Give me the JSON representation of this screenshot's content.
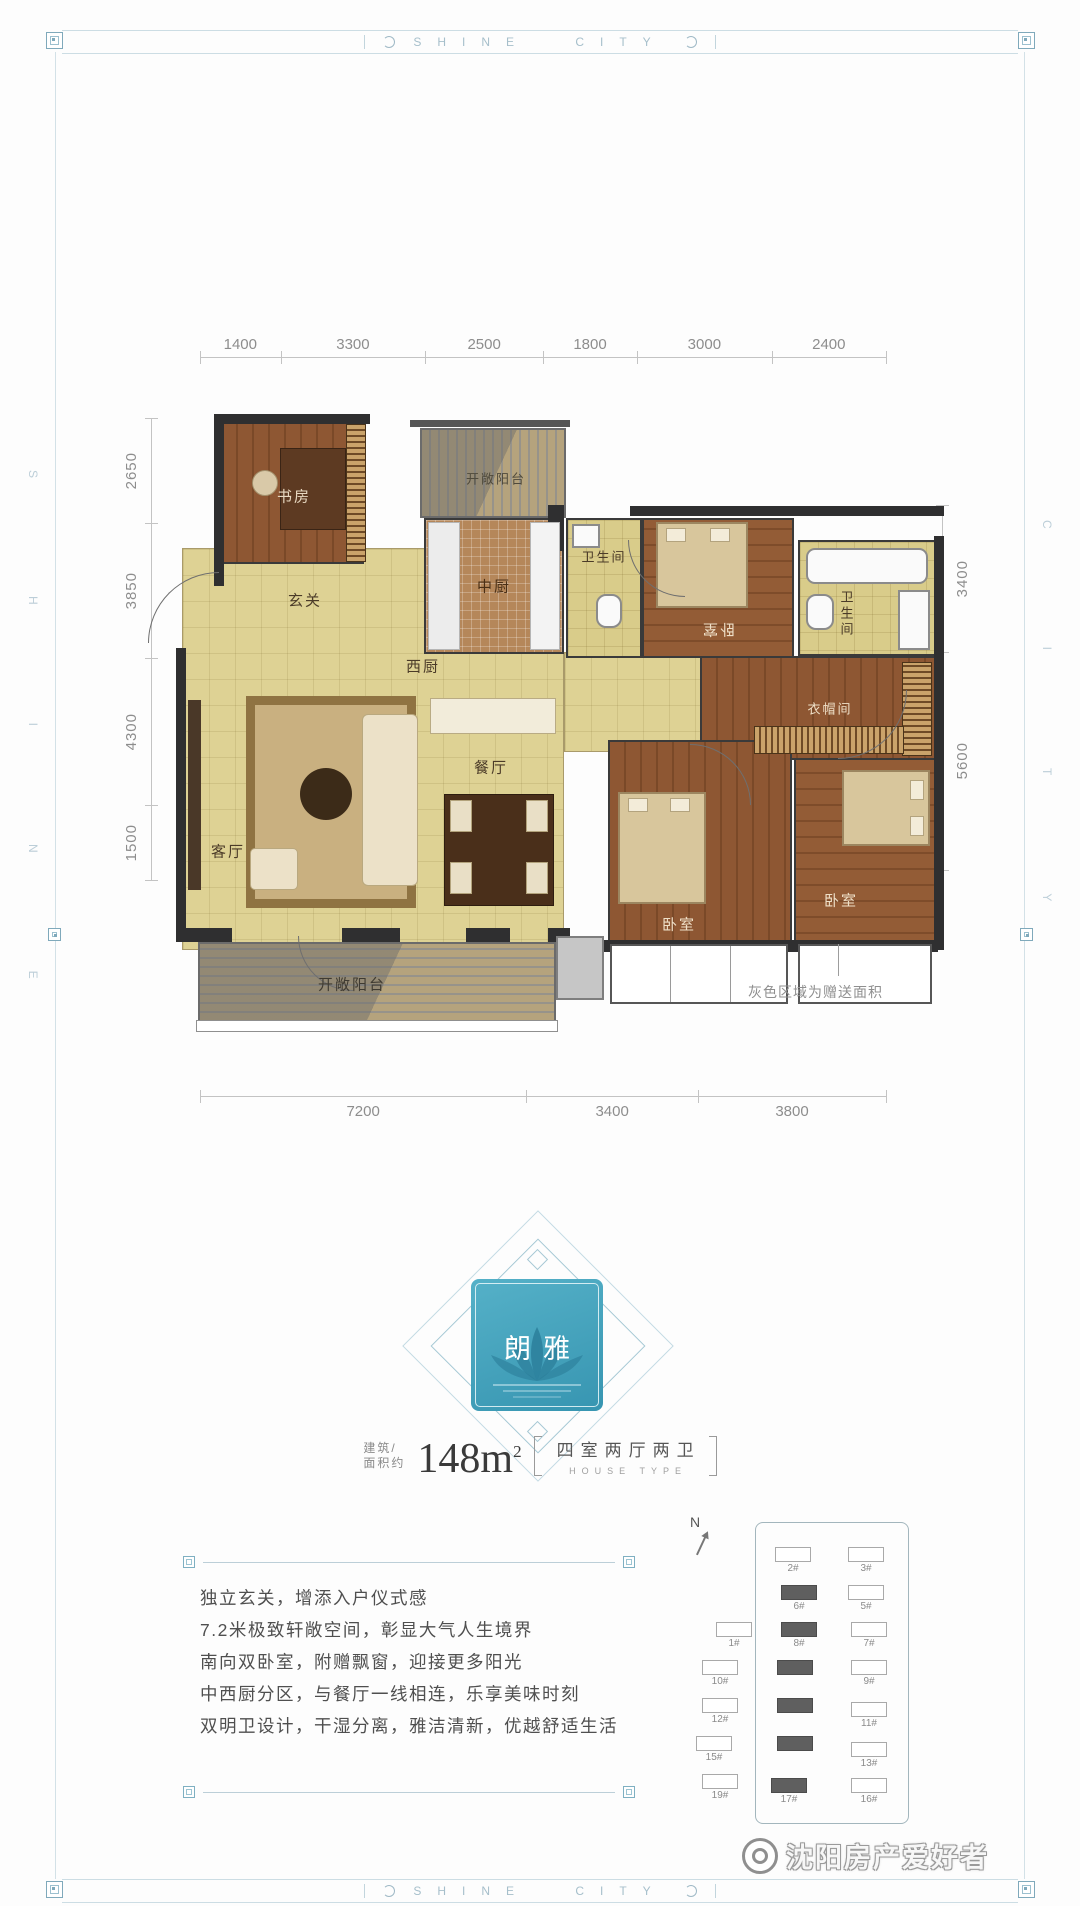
{
  "frame": {
    "brand_top": "SHINE CITY",
    "brand_bottom": "SHINE CITY",
    "side_left": "SHINE",
    "side_right": "CITY"
  },
  "floor_plan": {
    "dims_top": [
      "1400",
      "3300",
      "2500",
      "1800",
      "3000",
      "2400"
    ],
    "dims_left": [
      "2650",
      "3850",
      "4300",
      "1500"
    ],
    "dims_right": [
      "3400",
      "5600"
    ],
    "dims_bottom": [
      "7200",
      "3400",
      "3800"
    ],
    "rooms": {
      "study": "书房",
      "entry": "玄关",
      "service_balcony": "开敞阳台",
      "chinese_kitchen": "中厨",
      "western_kitchen": "西厨",
      "bath_1": "卫生间",
      "bedroom_north": "卧室",
      "bath_2": "卫生间",
      "cloakroom": "衣帽间",
      "dining": "餐厅",
      "living": "客厅",
      "bedroom_mid": "卧室",
      "bedroom_right": "卧室",
      "open_balcony": "开敞阳台"
    },
    "note": "灰色区域为赠送面积"
  },
  "badge": {
    "title": "朗雅"
  },
  "area_info": {
    "label_line1": "建筑/",
    "label_line2": "面积约",
    "value": "148m",
    "sup": "2",
    "type": "四室两厅两卫",
    "type_en": "HOUSE TYPE"
  },
  "features": [
    "独立玄关，增添入户仪式感",
    "7.2米极致轩敞空间，彰显大气人生境界",
    "南向双卧室，附赠飘窗，迎接更多阳光",
    "中西厨分区，与餐厅一线相连，乐享美味时刻",
    "双明卫设计，干湿分离，雅洁清新，优越舒适生活"
  ],
  "site_plan": {
    "compass": "N",
    "buildings": [
      {
        "label": "2#"
      },
      {
        "label": "3#"
      },
      {
        "label": "6#"
      },
      {
        "label": "5#"
      },
      {
        "label": "1#"
      },
      {
        "label": "8#"
      },
      {
        "label": "7#"
      },
      {
        "label": "10#"
      },
      {
        "label": "9#"
      },
      {
        "label": "12#"
      },
      {
        "label": "11#"
      },
      {
        "label": "15#"
      },
      {
        "label": "13#"
      },
      {
        "label": "19#"
      },
      {
        "label": "17#"
      },
      {
        "label": "16#"
      }
    ]
  },
  "watermark": {
    "text": "沈阳房产爱好者"
  },
  "colors": {
    "badge_teal": "#3f9fba",
    "frame_blue": "#b9cfda",
    "wall": "#2f2f30",
    "wood": "#8a5431",
    "tile": "#ded294",
    "gift_gray": "#9a9a9a"
  }
}
